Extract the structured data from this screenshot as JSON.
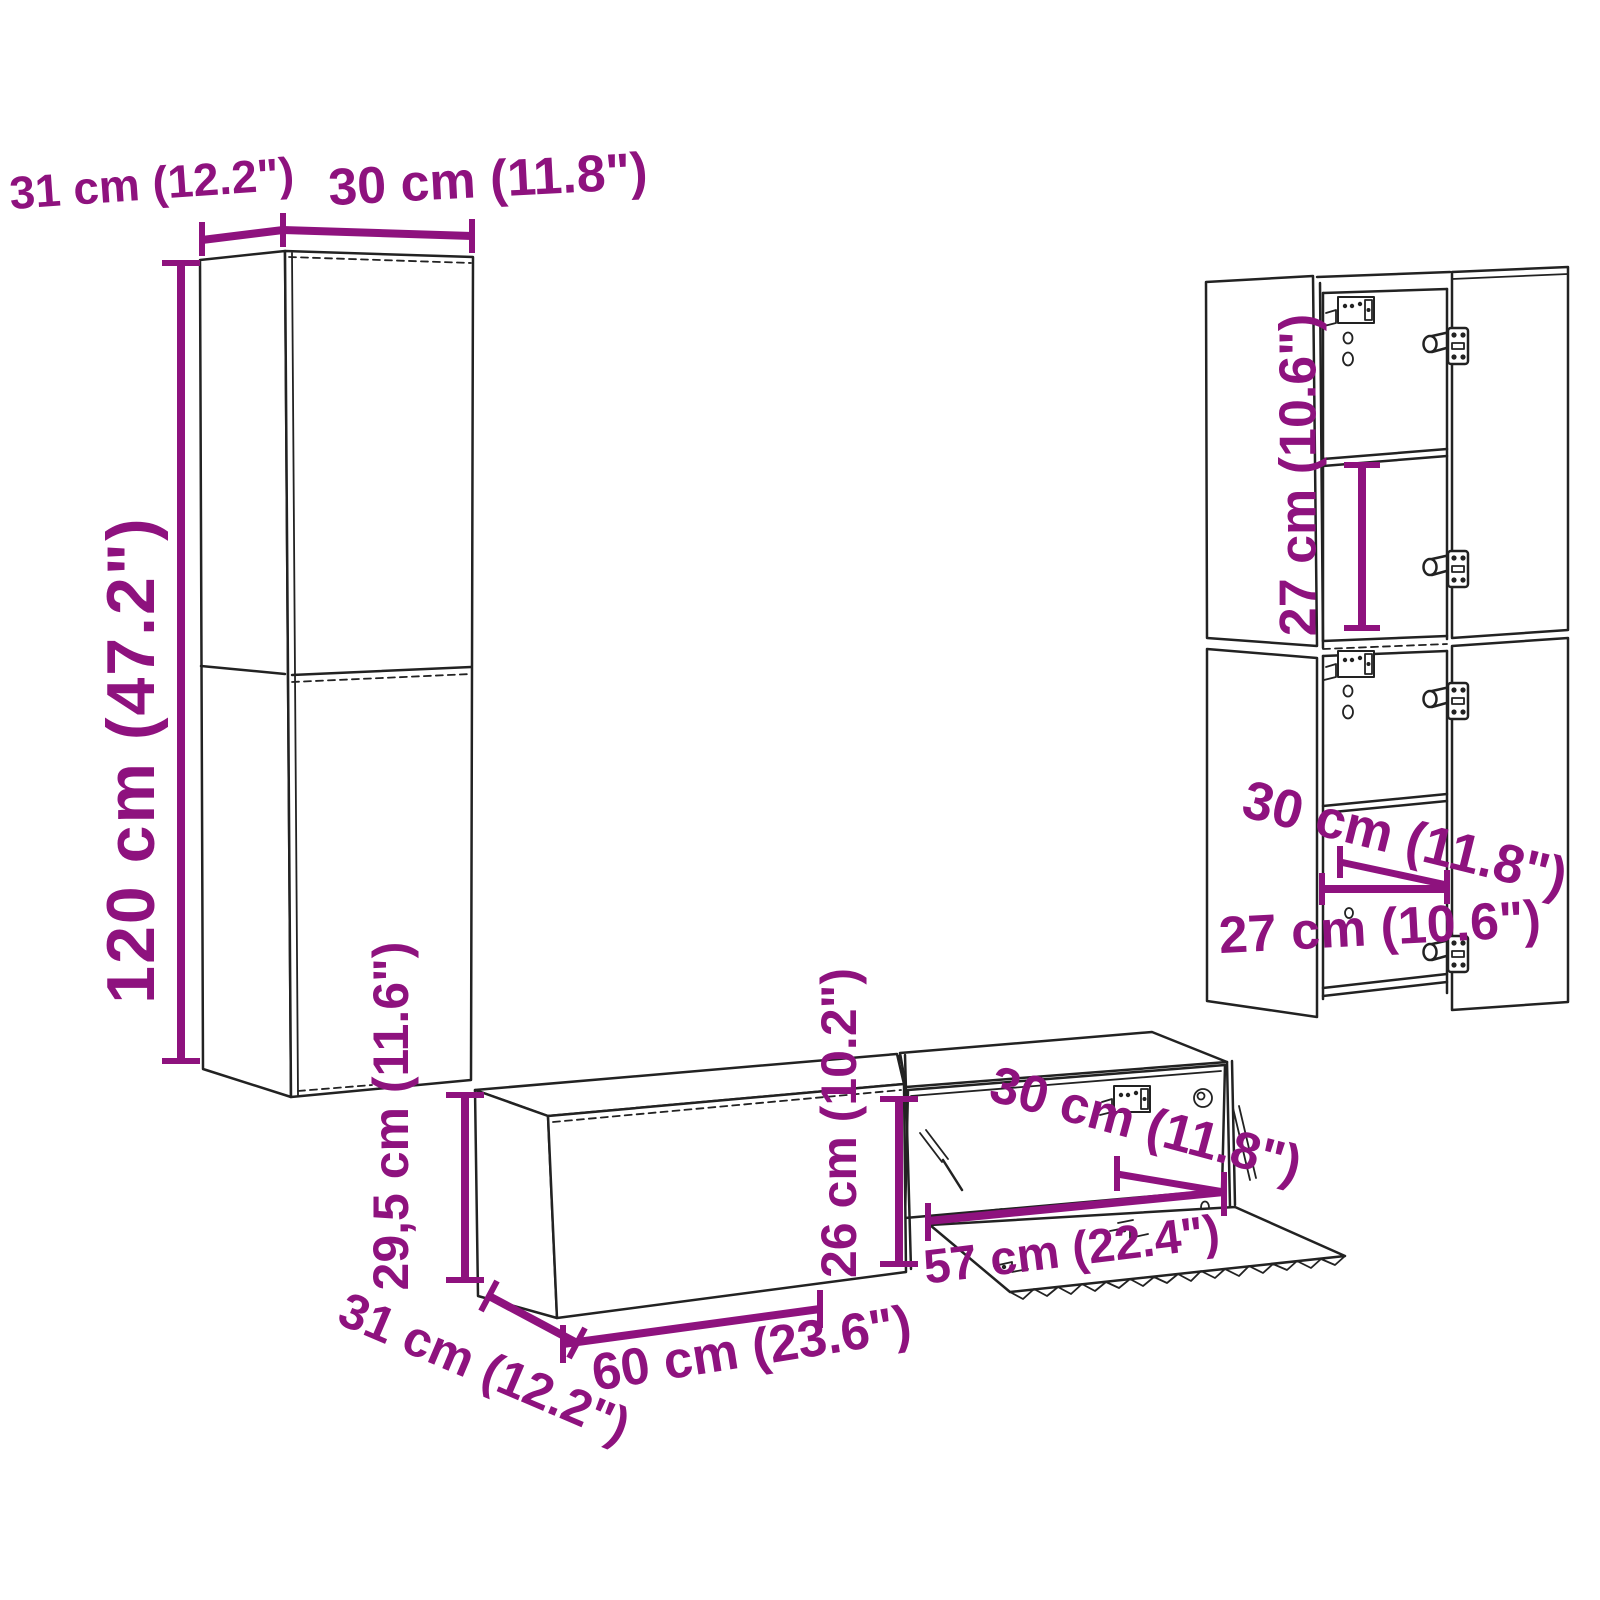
{
  "diagram": {
    "title": "wall-mounted TV furniture set dimension diagram",
    "colors": {
      "background": "#ffffff",
      "line": "#222222",
      "dimension": "#8E127E"
    },
    "labels": {
      "tall_cabinet_depth": "31 cm (12.2\")",
      "tall_cabinet_width": "30 cm (11.8\")",
      "tall_cabinet_height": "120 cm (47.2\")",
      "bench_height": "29,5 cm (11.6\")",
      "bench_depth": "31 cm (12.2\")",
      "bench_width": "60 cm (23.6\")",
      "bench_interior_height": "26 cm (10.2\")",
      "bench_interior_width": "57 cm (22.4\")",
      "bench_interior_depth": "30 cm (11.8\")",
      "wall_cabinet_shelf_height": "27 cm (10.6\")",
      "wall_cabinet_depth": "30 cm (11.8\")",
      "wall_cabinet_interior_width": "27 cm (10.6\")"
    }
  }
}
